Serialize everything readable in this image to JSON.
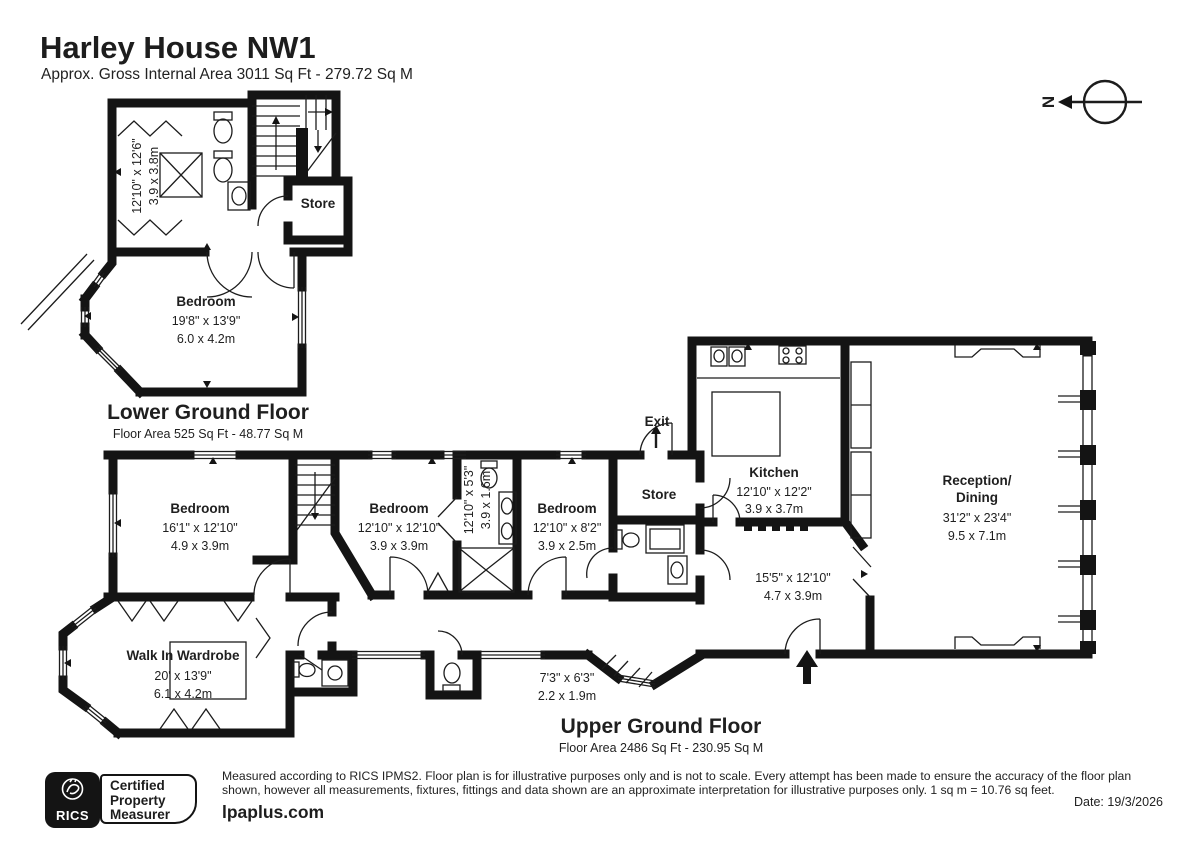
{
  "header": {
    "title": "Harley House NW1",
    "subtitle": "Approx. Gross Internal Area 3011 Sq Ft - 279.72 Sq M"
  },
  "compass": {
    "north": "N"
  },
  "colors": {
    "walls": "#141414",
    "background": "#ffffff",
    "text": "#1f1f1f"
  },
  "lgf": {
    "title": "Lower Ground Floor",
    "area": "Floor Area 525 Sq Ft - 48.77 Sq M",
    "shower_room": {
      "dims_ft": "12'10\" x 12'6\"",
      "dims_m": "3.9 x 3.8m"
    },
    "store": "Store",
    "bedroom": {
      "name": "Bedroom",
      "dims_ft": "19'8\" x 13'9\"",
      "dims_m": "6.0 x 4.2m"
    }
  },
  "ugf": {
    "title": "Upper Ground Floor",
    "area": "Floor Area 2486 Sq Ft - 230.95 Sq M",
    "bedroom1": {
      "name": "Bedroom",
      "dims_ft": "16'1\" x 12'10\"",
      "dims_m": "4.9 x 3.9m"
    },
    "bedroom2": {
      "name": "Bedroom",
      "dims_ft": "12'10\" x 12'10\"",
      "dims_m": "3.9 x 3.9m"
    },
    "bathroom": {
      "dims_ft": "12'10\" x 5'3\"",
      "dims_m": "3.9 x 1.6m"
    },
    "bedroom3": {
      "name": "Bedroom",
      "dims_ft": "12'10\" x 8'2\"",
      "dims_m": "3.9 x 2.5m"
    },
    "exit": "Exit",
    "store": "Store",
    "kitchen": {
      "name": "Kitchen",
      "dims_ft": "12'10\" x 12'2\"",
      "dims_m": "3.9 x 3.7m"
    },
    "reception": {
      "name_line1": "Reception/",
      "name_line2": "Dining",
      "dims_ft": "31'2\" x 23'4\"",
      "dims_m": "9.5 x 7.1m"
    },
    "hall": {
      "dims_ft": "15'5\" x 12'10\"",
      "dims_m": "4.7 x 3.9m"
    },
    "wardrobe": {
      "name": "Walk In Wardrobe",
      "dims_ft": "20' x 13'9\"",
      "dims_m": "6.1 x 4.2m"
    },
    "entrance_lobby": {
      "dims_ft": "7'3\" x 6'3\"",
      "dims_m": "2.2 x 1.9m"
    }
  },
  "footer": {
    "rics_label": "RICS",
    "certified": [
      "Certified",
      "Property",
      "Measurer"
    ],
    "disclaimer_line1": "Measured according to RICS IPMS2. Floor plan is for illustrative purposes only and is not to scale. Every attempt has been made to ensure the accuracy of the floor plan shown,",
    "disclaimer_line2": "however all measurements, fixtures, fittings and data shown are an approximate interpretation for illustrative purposes only. 1 sq m = 10.76 sq feet.",
    "website": "lpaplus.com",
    "date": "Date: 19/3/2026"
  }
}
